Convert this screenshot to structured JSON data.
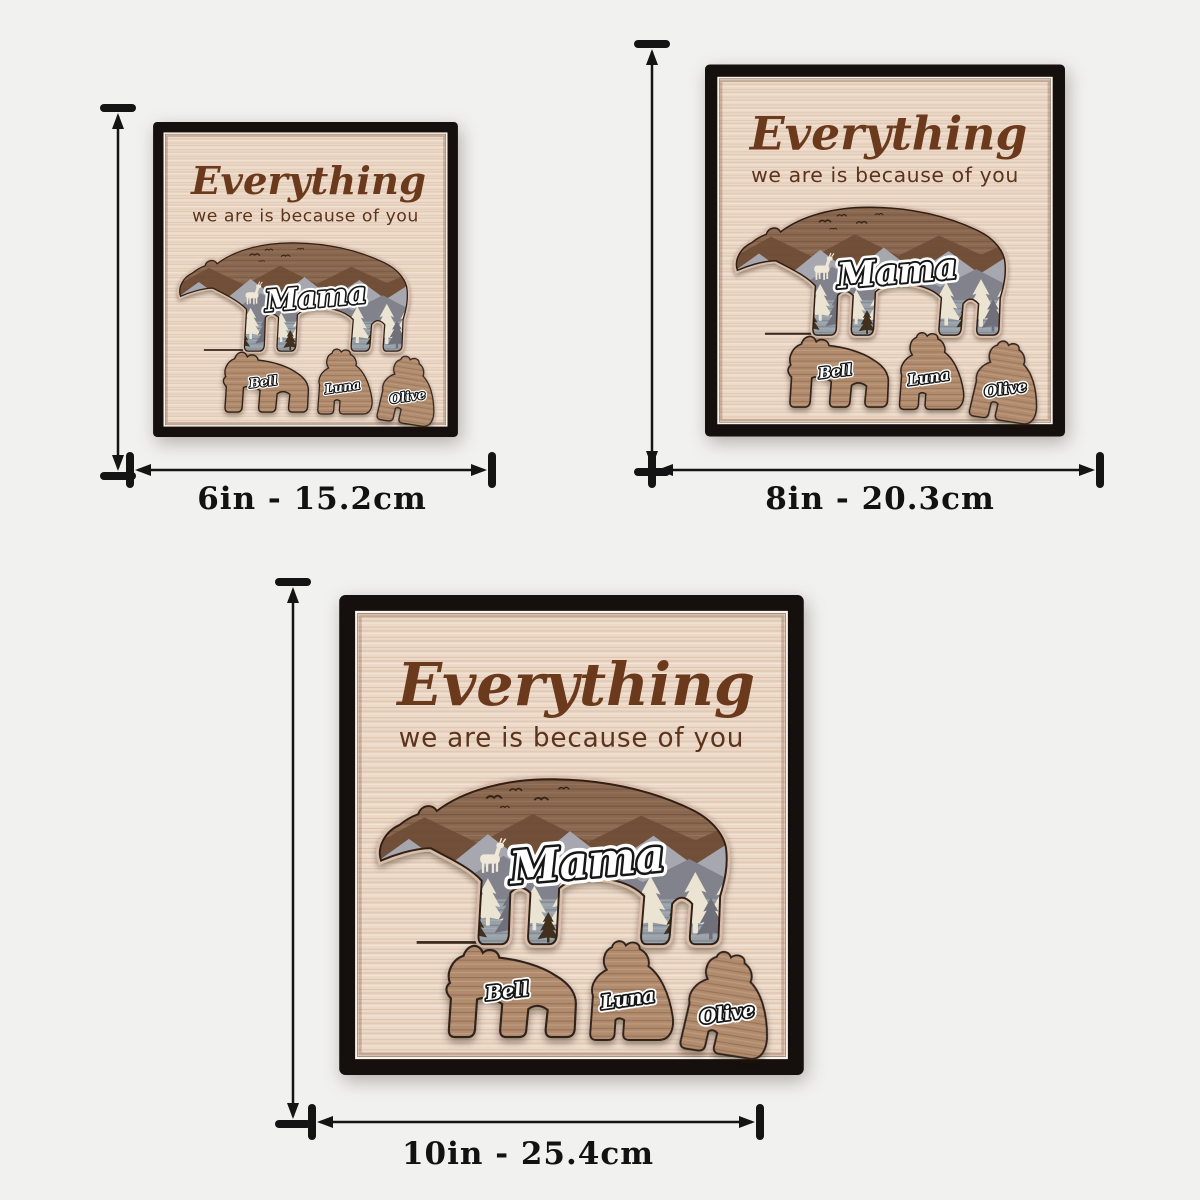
{
  "page": {
    "background_color": "#f1f1ef",
    "dimension_color": "#141414"
  },
  "artwork": {
    "title_script": "Everything",
    "subtitle": "we are is because of you",
    "mama_name": "Mama",
    "cub_names": [
      "Bell",
      "Luna",
      "Olive"
    ],
    "colors": {
      "frame_black": "#15100d",
      "wood_light": "#ecd9c8",
      "lettering_brown": "#6b3a1d",
      "subtitle_brown": "#5c341c",
      "bear_brown": "#8a6850",
      "ridge_brown": "#6e4d35",
      "mountain_gray_light": "#a7a7af",
      "mountain_gray_dark": "#82828c",
      "steel_gray": "#98a0a8",
      "tree_cream": "#ece4d3",
      "tree_dark": "#42301f",
      "cub_wood": "#b18b6d",
      "carve_rim": "#d9bca9"
    }
  },
  "variants": [
    {
      "name": "6-inch",
      "size_label": "6in - 15.2cm"
    },
    {
      "name": "8-inch",
      "size_label": "8in - 20.3cm"
    },
    {
      "name": "10-inch",
      "size_label": "10in - 25.4cm"
    }
  ]
}
